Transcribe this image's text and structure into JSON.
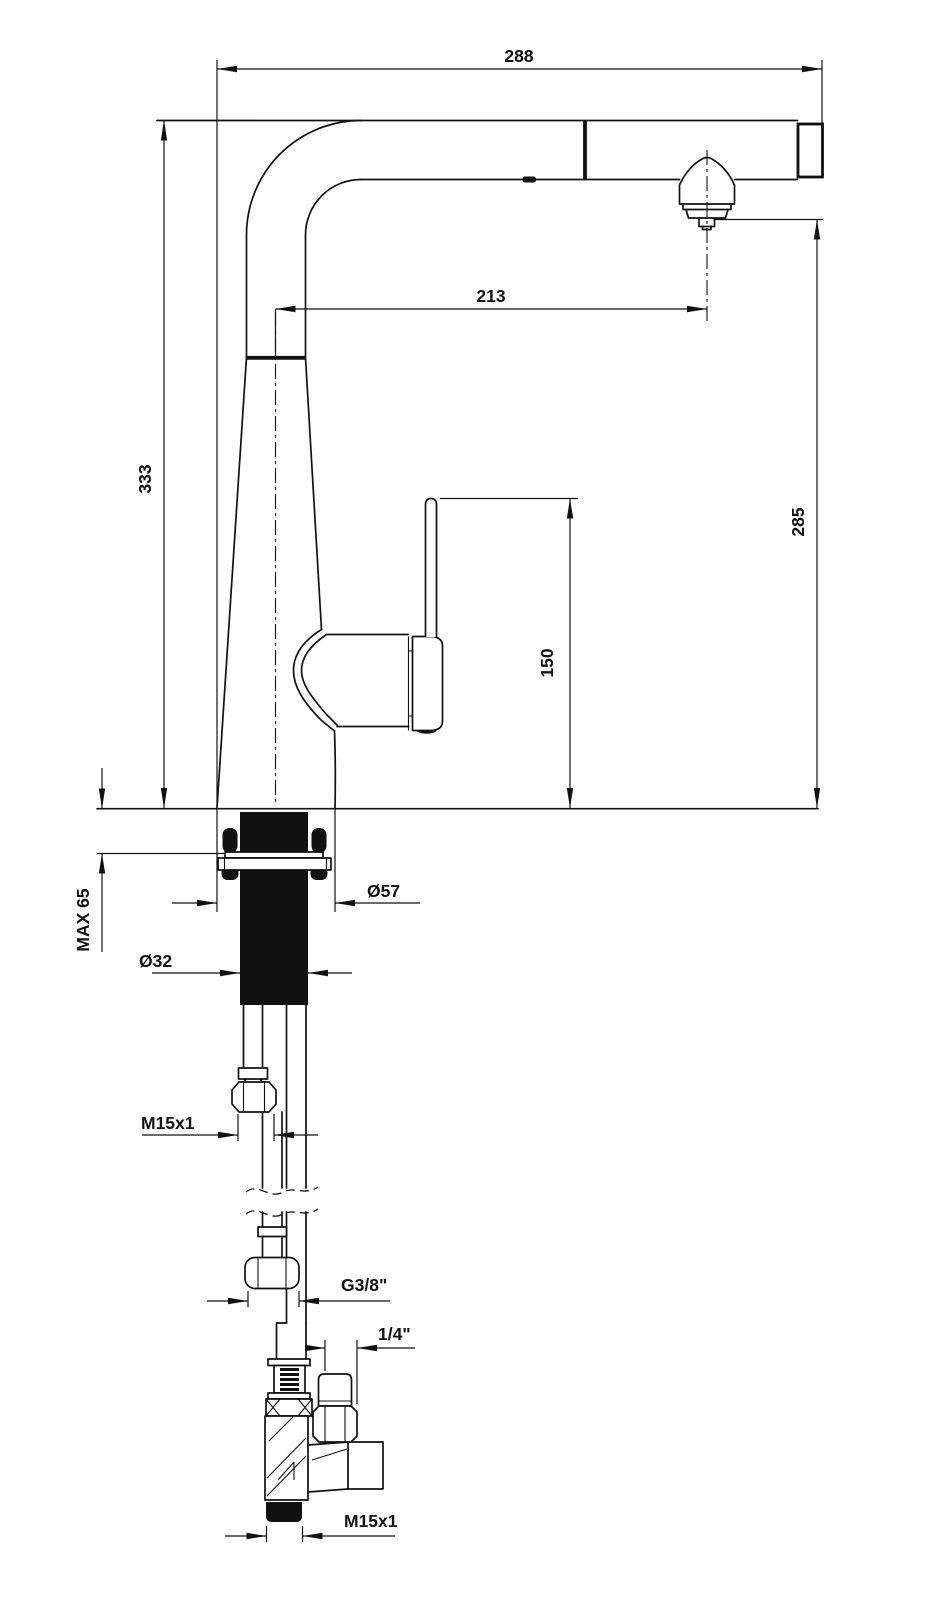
{
  "drawing": {
    "type": "faucet-technical-drawing",
    "dims": {
      "total_width": {
        "label": "288"
      },
      "spout_reach": {
        "label": "213"
      },
      "total_height": {
        "label": "333"
      },
      "spout_height": {
        "label": "285"
      },
      "handle_height": {
        "label": "150"
      },
      "counter_max": {
        "label": "MAX 65"
      },
      "base_dia": {
        "label": "Ø57"
      },
      "hole_dia": {
        "label": "Ø32"
      },
      "thread_supply": {
        "label": "M15x1"
      },
      "thread_main": {
        "label": "G3/8\""
      },
      "thread_branch": {
        "label": "1/4\""
      },
      "thread_bottom": {
        "label": "M15x1"
      }
    },
    "colors": {
      "ink": "#111111",
      "background": "#ffffff"
    }
  }
}
